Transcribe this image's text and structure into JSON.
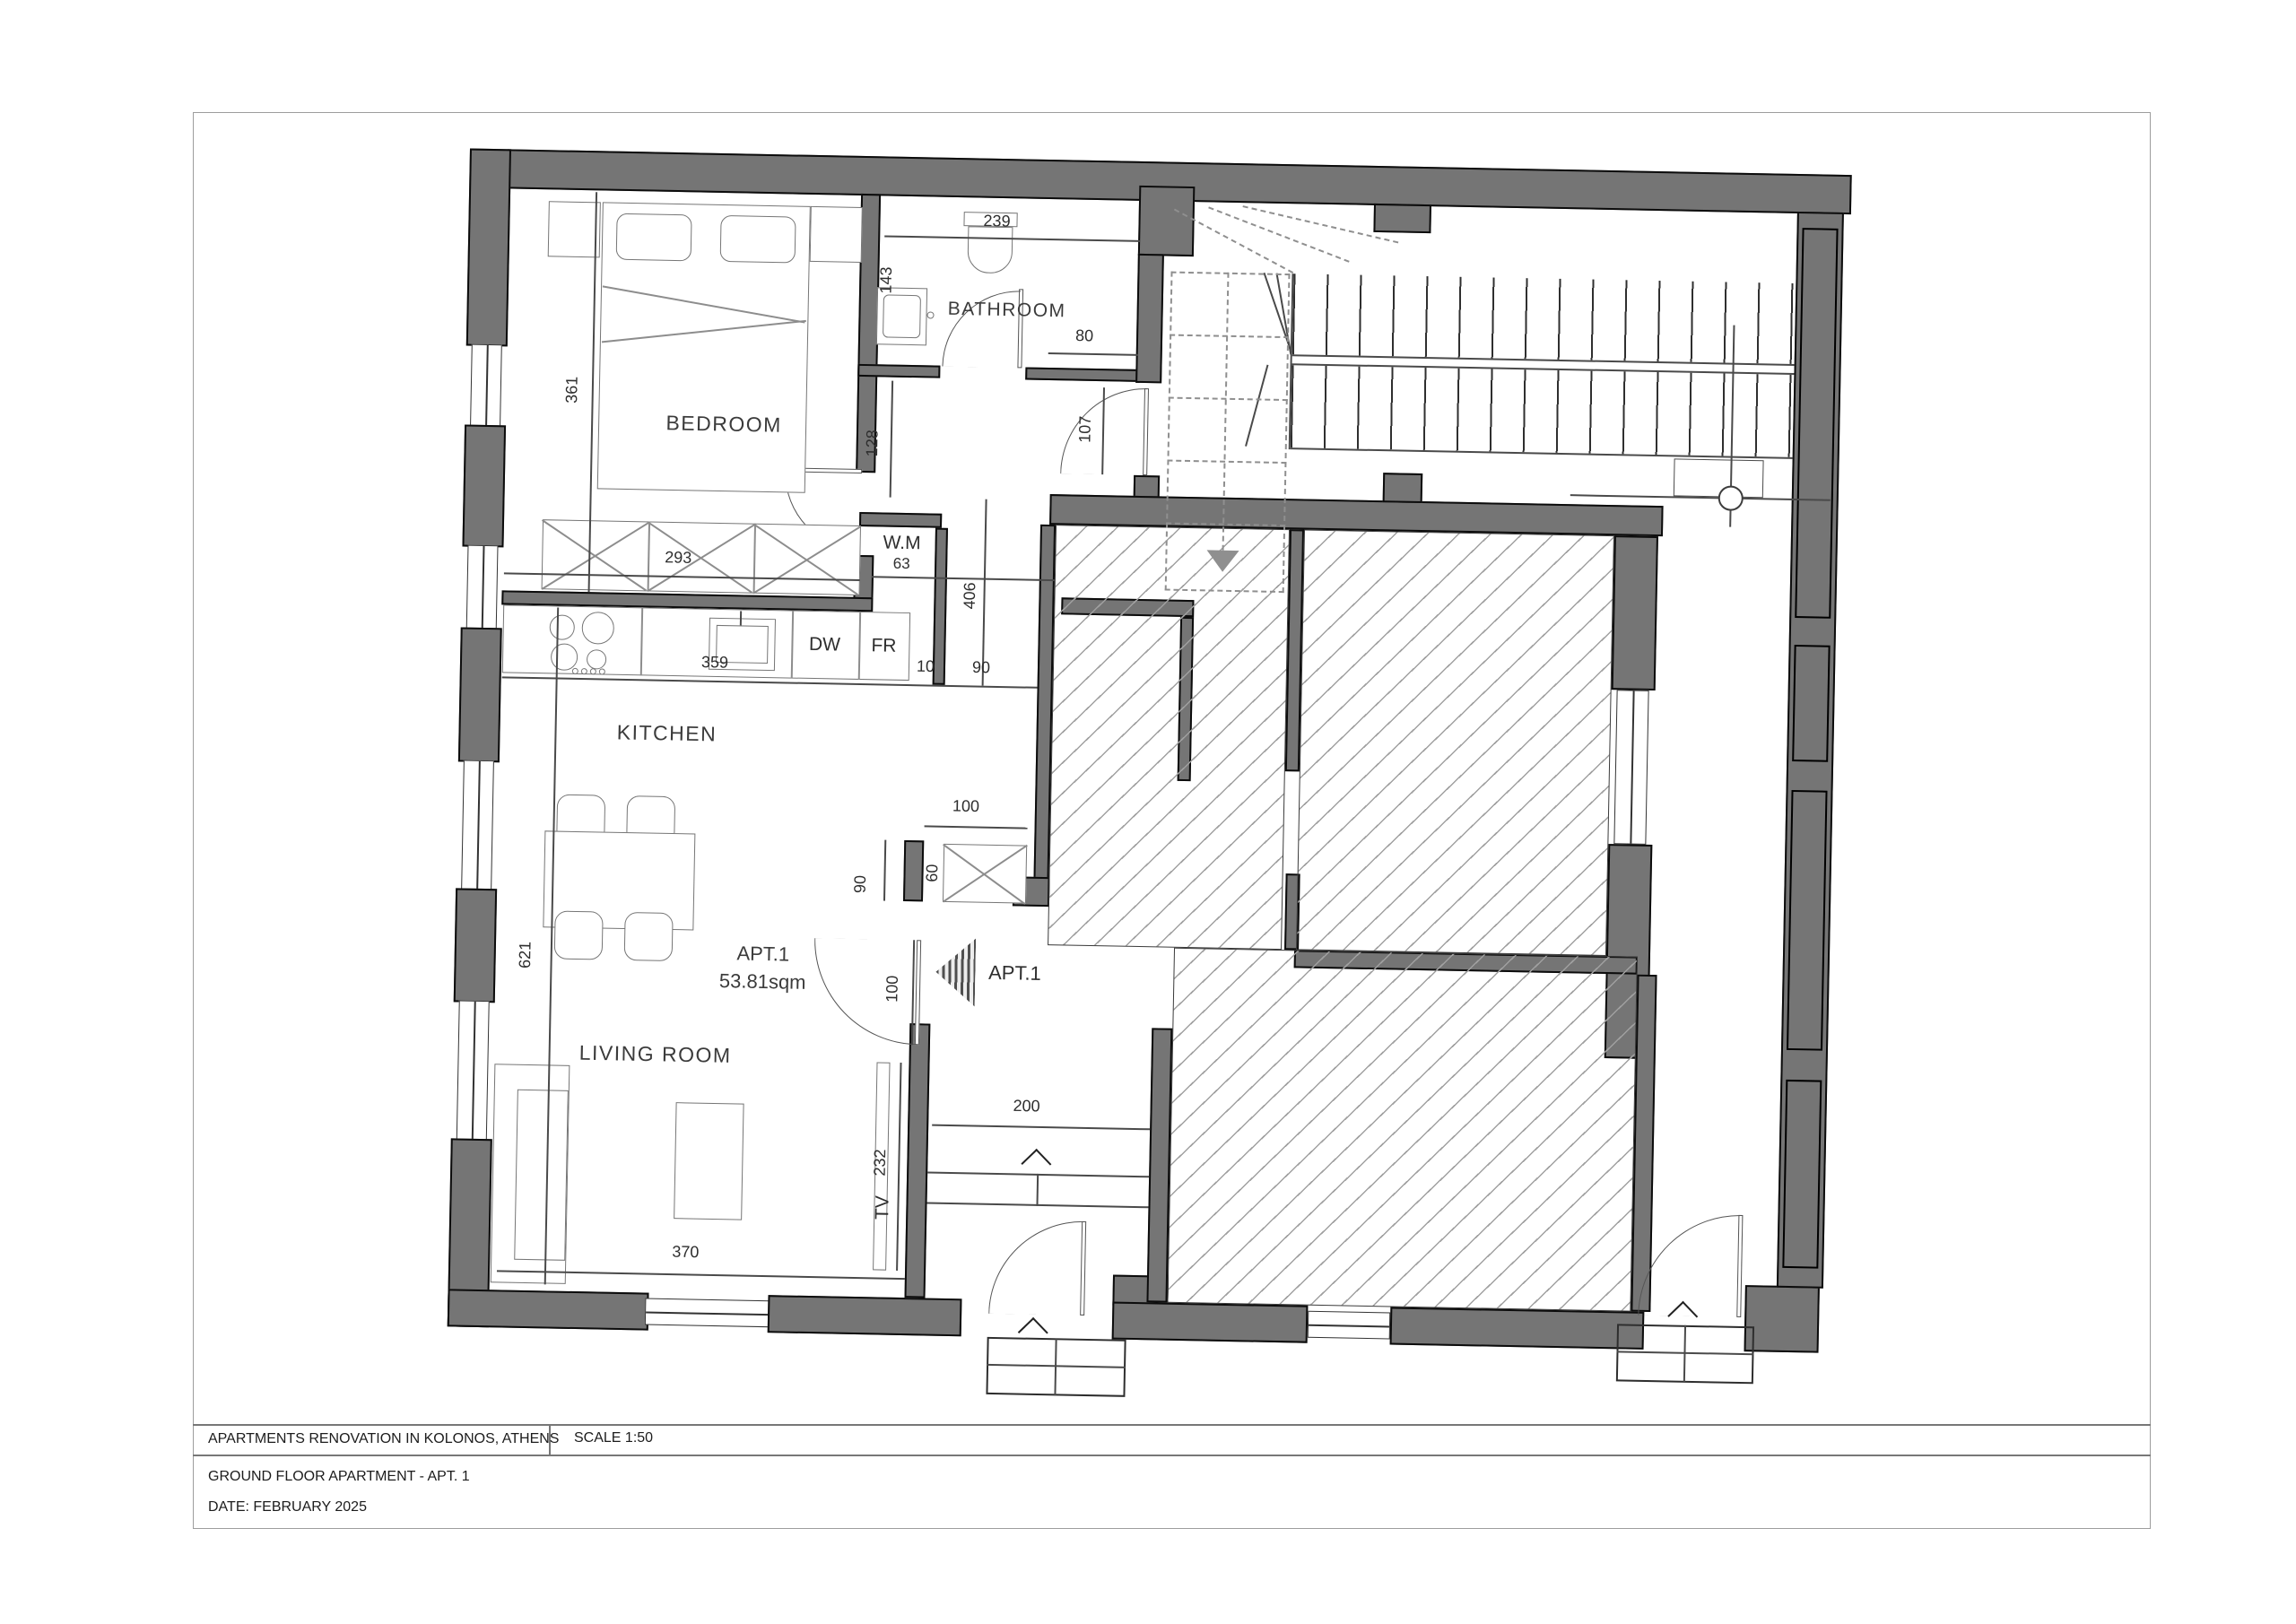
{
  "sheet": {
    "project_title": "APARTMENTS RENOVATION IN KOLONOS, ATHENS",
    "scale_label": "SCALE 1:50",
    "drawing_title": "GROUND FLOOR APARTMENT - APT. 1",
    "date_label": "DATE: FEBRUARY 2025"
  },
  "plan": {
    "rooms": {
      "bedroom": "BEDROOM",
      "bathroom": "BATHROOM",
      "kitchen": "KITCHEN",
      "living_room": "LIVING ROOM"
    },
    "apartment": {
      "entry_label": "APT.1",
      "name": "APT.1",
      "area": "53.81sqm"
    },
    "appliances": {
      "washing_machine": "W.M",
      "washing_machine_width": "63",
      "dishwasher": "DW",
      "fridge": "FR",
      "tv": "TV"
    },
    "dimensions": {
      "bathroom_width": "239",
      "bathroom_sink": "143",
      "bathroom_opening": "80",
      "stair_door": "107",
      "hall_width": "128",
      "bedroom_depth": "361",
      "wardrobe": "293",
      "corridor_length": "406",
      "kitchen_counter": "359",
      "wall_stub": "10",
      "kitchen_opening": "90",
      "closet_length": "100",
      "closet_depth": "60",
      "corridor_opening": "90",
      "apartment_door": "100",
      "living_kitchen_depth": "621",
      "vestibule_width": "200",
      "tv_wall": "232",
      "living_width": "370"
    },
    "colors": {
      "wall_fill": "#757575",
      "hatch_line": "#a0a0a0",
      "line": "#4a4a4a"
    }
  }
}
